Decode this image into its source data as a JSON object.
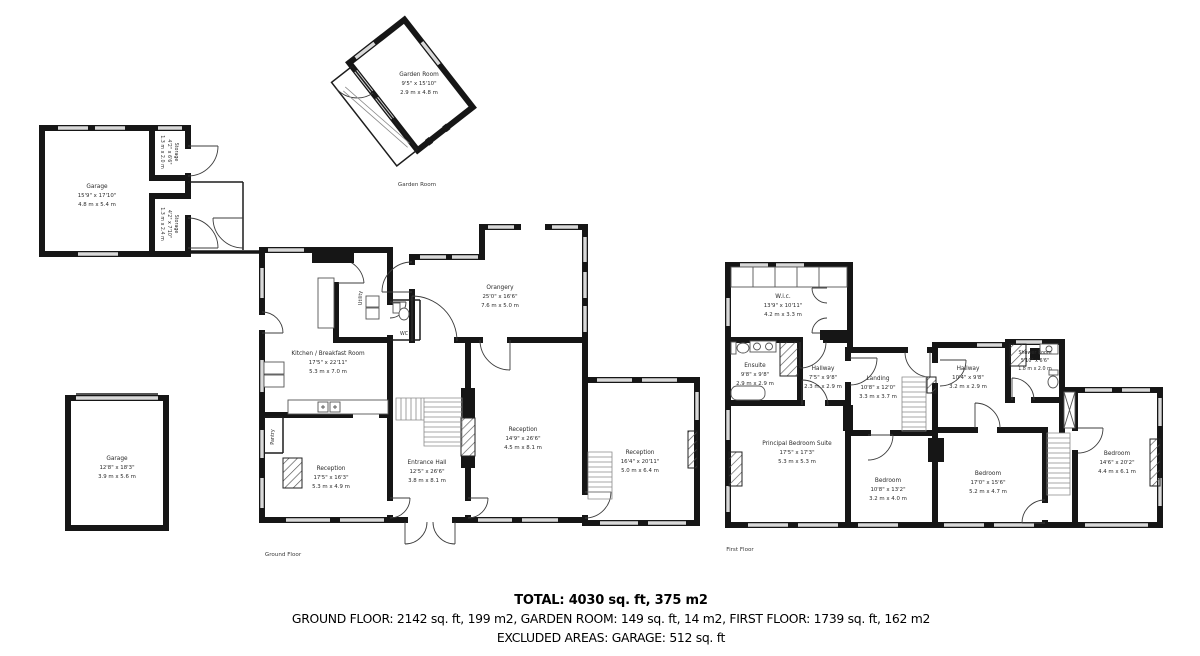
{
  "summary": {
    "total": "TOTAL: 4030 sq. ft, 375 m2",
    "breakdown": "GROUND FLOOR: 2142 sq. ft, 199 m2, GARDEN ROOM: 149 sq. ft, 14 m2, FIRST FLOOR: 1739 sq. ft, 162 m2",
    "excluded": "EXCLUDED AREAS: GARAGE: 512 sq. ft"
  },
  "captions": {
    "garden_room": "Garden Room",
    "ground_floor": "Ground Floor",
    "first_floor": "First Floor"
  },
  "rooms": {
    "garden_room": {
      "name": "Garden Room",
      "imperial": "9'5\" x 15'10\"",
      "metric": "2.9 m x 4.8 m"
    },
    "garage_top": {
      "name": "Garage",
      "imperial": "15'9\" x 17'10\"",
      "metric": "4.8 m x 5.4 m"
    },
    "storage_top": {
      "name": "Storage",
      "imperial": "4'2\" x 6'6\"",
      "metric": "1.3 m x 2.0 m"
    },
    "storage_bottom": {
      "name": "Storage",
      "imperial": "4'2\" x 7'10\"",
      "metric": "1.3 m x 2.4 m"
    },
    "kitchen": {
      "name": "Kitchen / Breakfast Room",
      "imperial": "17'5\" x 22'11\"",
      "metric": "5.3 m x 7.0 m"
    },
    "utility": {
      "name": "Utility"
    },
    "wc": {
      "name": "WC"
    },
    "pantry": {
      "name": "Pantry"
    },
    "orangery": {
      "name": "Orangery",
      "imperial": "25'0\" x 16'6\"",
      "metric": "7.6 m x 5.0 m"
    },
    "reception_center": {
      "name": "Reception",
      "imperial": "14'9\" x 26'6\"",
      "metric": "4.5 m x 8.1 m"
    },
    "entrance_hall": {
      "name": "Entrance Hall",
      "imperial": "12'5\" x 26'6\"",
      "metric": "3.8 m x 8.1 m"
    },
    "reception_left": {
      "name": "Reception",
      "imperial": "17'5\" x 16'3\"",
      "metric": "5.3 m x 4.9 m"
    },
    "reception_right": {
      "name": "Reception",
      "imperial": "16'4\" x 20'11\"",
      "metric": "5.0 m x 6.4 m"
    },
    "garage_bottom": {
      "name": "Garage",
      "imperial": "12'8\" x 18'3\"",
      "metric": "3.9 m x 5.6 m"
    },
    "wic": {
      "name": "W.i.c.",
      "imperial": "13'9\" x 10'11\"",
      "metric": "4.2 m x 3.3 m"
    },
    "ensuite": {
      "name": "Ensuite",
      "imperial": "9'8\" x 9'8\"",
      "metric": "2.9 m x 2.9 m"
    },
    "hallway_left": {
      "name": "Hallway",
      "imperial": "7'5\" x 9'8\"",
      "metric": "2.3 m x 2.9 m"
    },
    "landing": {
      "name": "Landing",
      "imperial": "10'8\" x 12'0\"",
      "metric": "3.3 m x 3.7 m"
    },
    "hallway_right": {
      "name": "Hallway",
      "imperial": "10'4\" x 9'8\"",
      "metric": "3.2 m x 2.9 m"
    },
    "shower_room": {
      "name": "Shower Room",
      "imperial": "5'10\" x 6'6\"",
      "metric": "1.8 m x 2.0 m"
    },
    "principal_bedroom": {
      "name": "Principal Bedroom Suite",
      "imperial": "17'5\" x 17'3\"",
      "metric": "5.3 m x 5.3 m"
    },
    "bedroom_small": {
      "name": "Bedroom",
      "imperial": "10'8\" x 13'2\"",
      "metric": "3.2 m x 4.0 m"
    },
    "bedroom_mid": {
      "name": "Bedroom",
      "imperial": "17'0\" x 15'6\"",
      "metric": "5.2 m x 4.7 m"
    },
    "bedroom_right": {
      "name": "Bedroom",
      "imperial": "14'6\" x 20'2\"",
      "metric": "4.4 m x 6.1 m"
    }
  },
  "colors": {
    "wall": "#161616",
    "window": "#d9d9d9",
    "hatch": "#555555"
  }
}
